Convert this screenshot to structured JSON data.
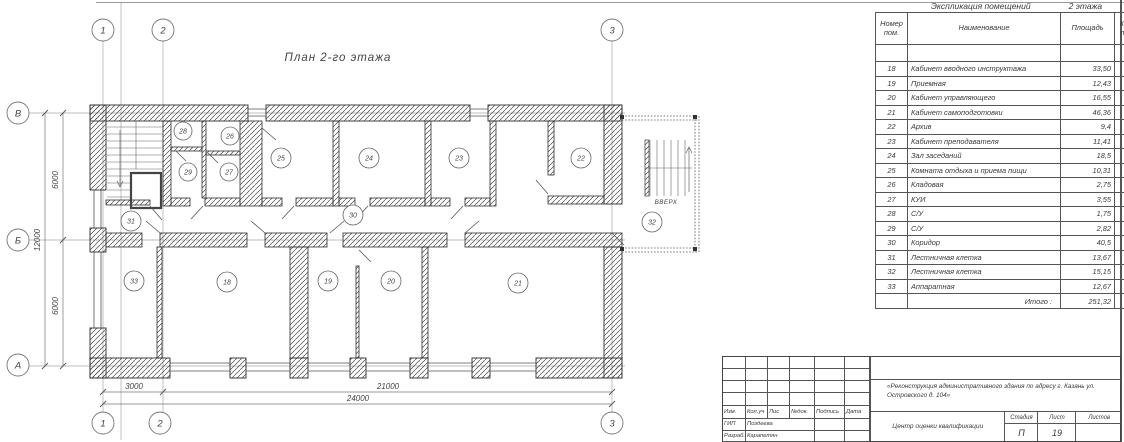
{
  "plan": {
    "title": "План 2-го этажа",
    "stair_label": "ВВЕРХ",
    "axes": {
      "top": [
        "1",
        "2",
        "3"
      ],
      "left": [
        "В",
        "Б",
        "А"
      ]
    },
    "dims": {
      "left": [
        "6000",
        "6000",
        "12000"
      ],
      "bottom": [
        "3000",
        "21000",
        "24000"
      ]
    },
    "rooms": {
      "r18": "18",
      "r19": "19",
      "r20": "20",
      "r21": "21",
      "r22": "22",
      "r23": "23",
      "r24": "24",
      "r25": "25",
      "r26": "26",
      "r27": "27",
      "r28": "28",
      "r29": "29",
      "r30": "30",
      "r31": "31",
      "r32": "32",
      "r33": "33"
    }
  },
  "table": {
    "title": "Экспликация помещений",
    "title_suffix": "2 этажа",
    "columns": {
      "num": "Номер пом.",
      "name": "Наименование",
      "area": "Площадь",
      "cat": "Кат. пом."
    },
    "rows": [
      [
        "18",
        "Кабинет вводного инструктажа",
        "33,50"
      ],
      [
        "19",
        "Приемная",
        "12,43"
      ],
      [
        "20",
        "Кабинет управляющего",
        "16,55"
      ],
      [
        "21",
        "Кабинет самоподготовки",
        "46,36"
      ],
      [
        "22",
        "Архив",
        "9,4"
      ],
      [
        "23",
        "Кабинет преподавателя",
        "11,41"
      ],
      [
        "24",
        "Зал заседаний",
        "18,5"
      ],
      [
        "25",
        "Комната отдыха и приема пищи",
        "10,31"
      ],
      [
        "26",
        "Кладовая",
        "2,75"
      ],
      [
        "27",
        "КУИ",
        "3,55"
      ],
      [
        "28",
        "С/У",
        "1,75"
      ],
      [
        "29",
        "С/У",
        "2,82"
      ],
      [
        "30",
        "Коридор",
        "40,5"
      ],
      [
        "31",
        "Лестничная клетка",
        "13,67"
      ],
      [
        "32",
        "Лестничная клетка",
        "15,15"
      ],
      [
        "33",
        "Аппаратная",
        "12,67"
      ]
    ],
    "total_label": "Итого :",
    "total_value": "251,32"
  },
  "titleblock": {
    "cols": [
      "Изм.",
      "Кол.уч",
      "Лис",
      "№док.",
      "Подпись",
      "Дата"
    ],
    "roles": [
      {
        "role": "ГИП",
        "name": "Поздеева"
      },
      {
        "role": "Разраб.",
        "name": "Карапетян"
      }
    ],
    "project": "«Реконструкция административного здания по адресу г. Казань ул. Островского д. 104»",
    "doc_title": "Центр оценки квалификации",
    "stage_label": "Стадия",
    "sheet_label": "Лист",
    "sheets_label": "Листов",
    "stage": "П",
    "sheet": "19",
    "sheets": ""
  }
}
